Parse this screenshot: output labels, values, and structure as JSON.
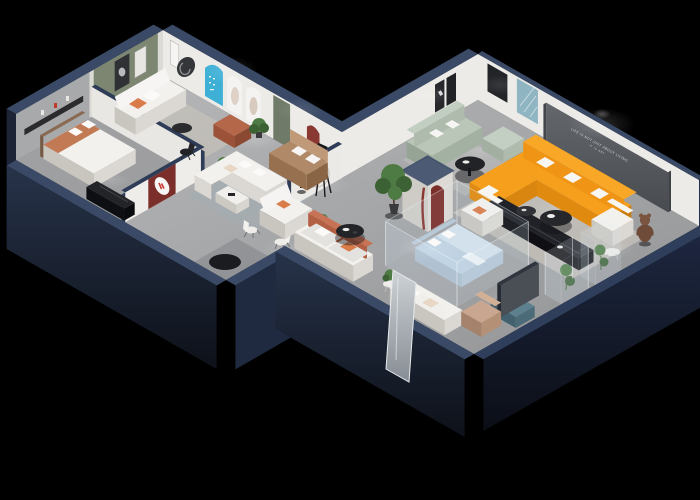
{
  "scene": {
    "type": "3d-isometric-showroom-floorplan-render",
    "background": "#000000",
    "slogan": {
      "line1": "LIFE IS NOT JUST ABOUT LIVING",
      "line2": "IT IS ART"
    }
  },
  "palette": {
    "bg": "#000000",
    "navy_cap": "#3a4a66",
    "navy_face": "#24304a",
    "navy_deep": "#10151f",
    "navy_edge": "#2e3c57",
    "floor_hi": "#b6b7b9",
    "floor_lo": "#97989a",
    "floor_bed": "#8f9092",
    "wall": "#edebe7",
    "wall_dark": "#dcdad5",
    "gray_wall": "#a7a9ab",
    "green_wall": "#7c8671",
    "tv_wall": "#5a5d62",
    "slogan_color": "#d9d9d5",
    "arch_blue": "#3eb0d6",
    "arch_red": "#8a3832",
    "maroon_panel": "#7c2e2a",
    "door_green": "#6f7a68",
    "orange": "#f59f1c",
    "orange_dark": "#e08a10",
    "orange_deep": "#c97d0e",
    "terracotta": "#c27a55",
    "rust": "#b5674a",
    "tan": "#b08968",
    "tan_dark": "#8a6545",
    "sage": "#b9c6b8",
    "sage_dark": "#a3b1a2",
    "white_sofa": "#f2f1ee",
    "white_shade": "#dbd8d3",
    "white_dark": "#c9c6c0",
    "cream_rug": "#d8d2c6",
    "blue_rug": "#9fb0b5",
    "beige_rug": "#cfc9bd",
    "bed_blue": "#d3e1ec",
    "duvet_blue": "#bfd2e2",
    "teal_bench": "#5d808f",
    "black_furn": "#1b1c20",
    "plant": "#4e7a43",
    "plant_dark": "#3c6134",
    "teddy": "#6f4b39",
    "mirror_hi": "#cdd2d6",
    "mirror_lo": "#878d94",
    "statue": "#232329"
  }
}
